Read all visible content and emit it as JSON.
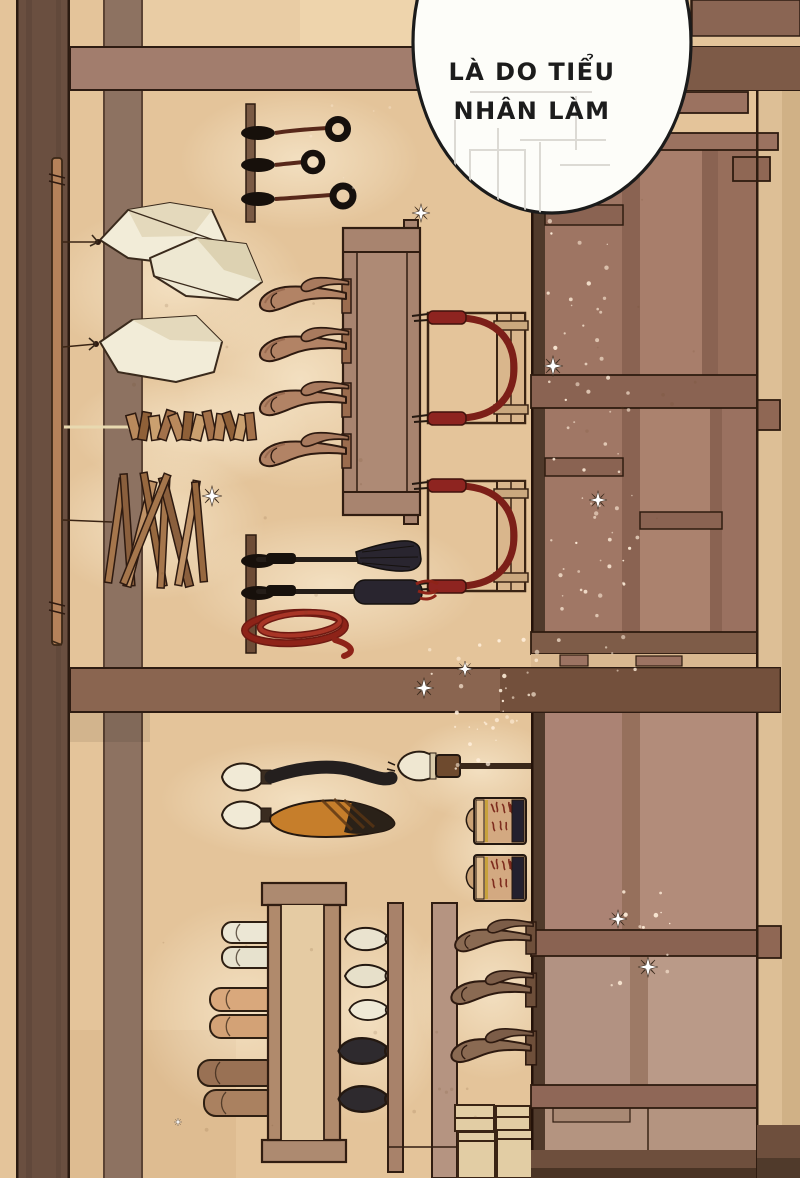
{
  "panel": {
    "type": "comic-panel",
    "dialogue": {
      "bubble": {
        "lines": [
          "LÀ DO TIỂU",
          "NHÂN LÀM"
        ],
        "text": "LÀ DO TIỂU NHÂN LÀM",
        "language": "Vietnamese"
      }
    },
    "scene": {
      "setting": "wooden shop interior wall display viewed sideways",
      "objects": [
        "hanging-rings-display",
        "white-cloth-pouches",
        "wooden-clapper-string",
        "wooden-rod-bundle",
        "display-bench",
        "wooden-phallus-display-upper",
        "rope-chair-1",
        "rope-chair-2",
        "flogger-whip",
        "leather-paddle",
        "coiled-red-rope",
        "black-tail-plug",
        "fox-tail-plug",
        "calligraphy-brush",
        "patterned-jar-1",
        "patterned-jar-2",
        "display-table-lower",
        "wooden-cylinder-display",
        "plug-display",
        "wooden-phallus-display-lower",
        "storage-boxes",
        "large-wooden-shelf",
        "support-post",
        "wooden-staff",
        "cross-beams",
        "sparkles"
      ]
    },
    "palette": {
      "wall": "#e4c49a",
      "post": "#6a4f40",
      "beam": "#a27d6d",
      "shelf_wood": "#9e7563",
      "shelf_wood_light": "#b29282",
      "accent_red": "#8e2318",
      "implement_black": "#29252f",
      "cloth_white": "#f2ecd8",
      "tail_orange": "#c67e2b",
      "bubble_fill": "#fdfdf9",
      "bubble_stroke": "#1b1b1b"
    }
  }
}
